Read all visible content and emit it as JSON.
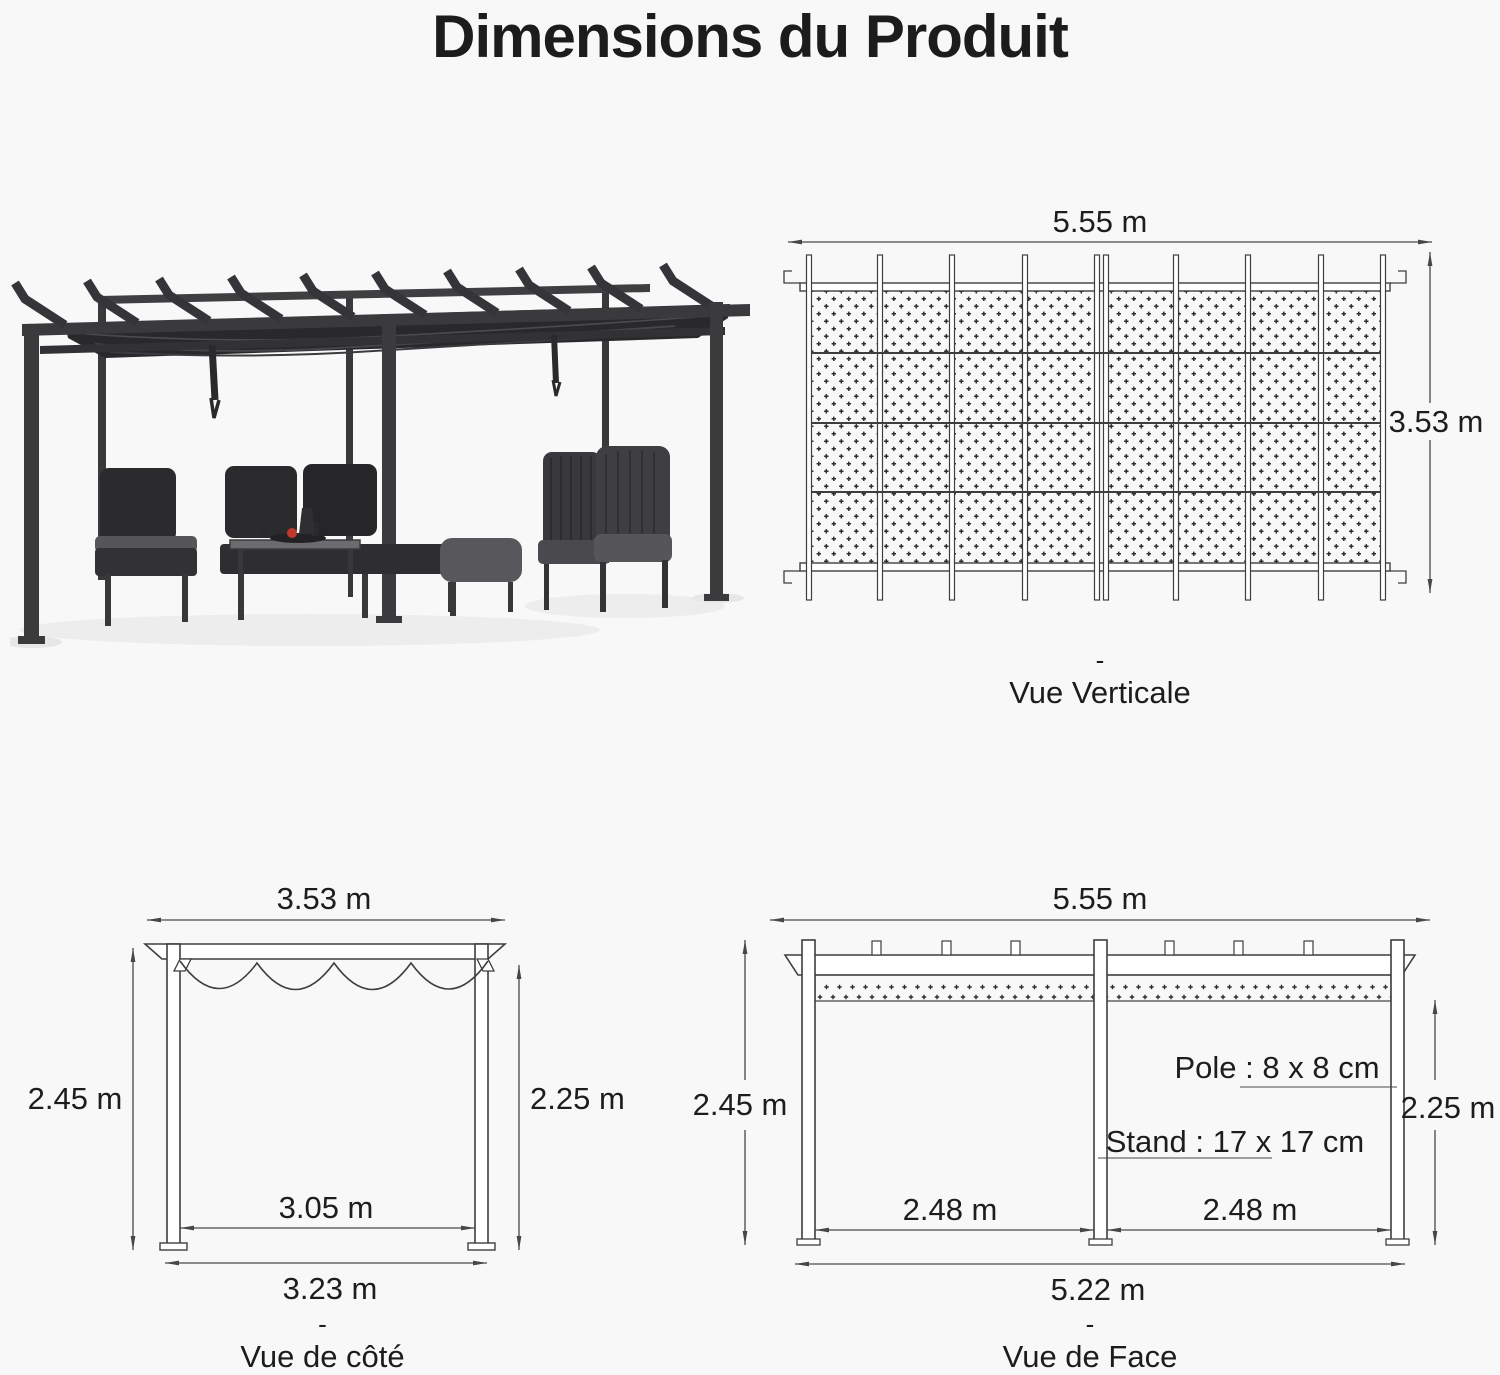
{
  "title": "Dimensions du Produit",
  "colors": {
    "background": "#f8f8f8",
    "diagram_line": "#3e3e3e",
    "dimension_line": "#474747",
    "text": "#1c1c1c",
    "pergola_frame": "#3a3a3d",
    "canopy": "#29292c",
    "accent_red": "#c0392b"
  },
  "views": {
    "vertical": {
      "width_label": "5.55 m",
      "depth_label": "3.53 m",
      "caption_dash": "-",
      "caption": "Vue Verticale"
    },
    "side": {
      "top_width_label": "3.53 m",
      "left_height_label": "2.45 m",
      "right_height_label": "2.25 m",
      "inner_width_label": "3.05 m",
      "base_width_label": "3.23 m",
      "caption_dash": "-",
      "caption": "Vue de côté"
    },
    "front": {
      "top_width_label": "5.55 m",
      "left_height_label": "2.45 m",
      "right_height_label": "2.25 m",
      "pole_label": "Pole : 8 x 8 cm",
      "stand_label": "Stand : 17 x 17 cm",
      "left_span_label": "2.48 m",
      "right_span_label": "2.48 m",
      "base_width_label": "5.22 m",
      "caption_dash": "-",
      "caption": "Vue de Face"
    }
  }
}
